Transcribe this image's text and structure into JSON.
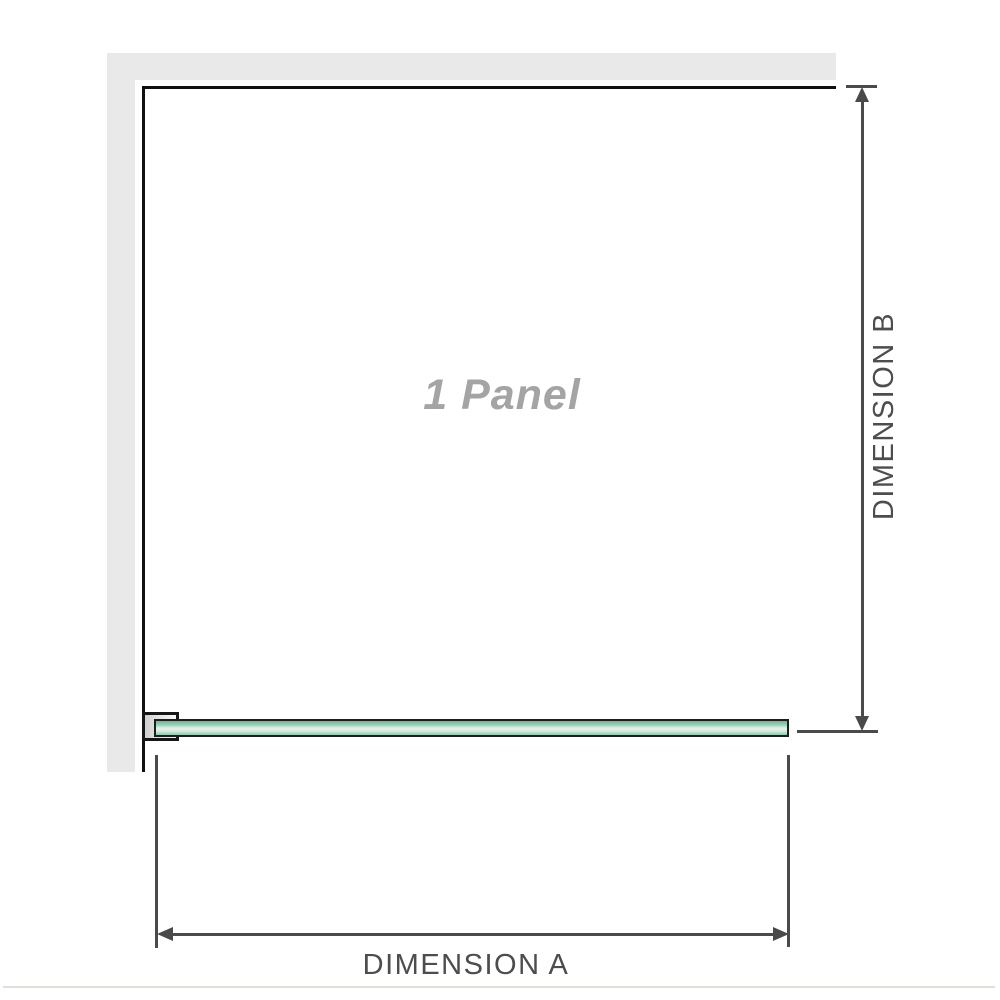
{
  "diagram": {
    "panel_label": "1 Panel",
    "dimension_a": {
      "label": "DIMENSION A"
    },
    "dimension_b": {
      "label": "DIMENSION B"
    }
  },
  "colors": {
    "background": "#ffffff",
    "wall_fill": "#e9e9e9",
    "wall_line": "#101010",
    "dimension_line": "#4a4a4a",
    "dimension_label_text": "#4d4d4d",
    "panel_label_text": "#a4a4a4",
    "glass_border": "#182019",
    "glass_gradient": [
      "#74b593",
      "#9ccfb3",
      "#e4f3eb",
      "#d3ecdf",
      "#8fc7a9"
    ],
    "bracket_border": "#161616",
    "bracket_fill": "#cfcfcf",
    "separator_line": "#e0ded6"
  }
}
